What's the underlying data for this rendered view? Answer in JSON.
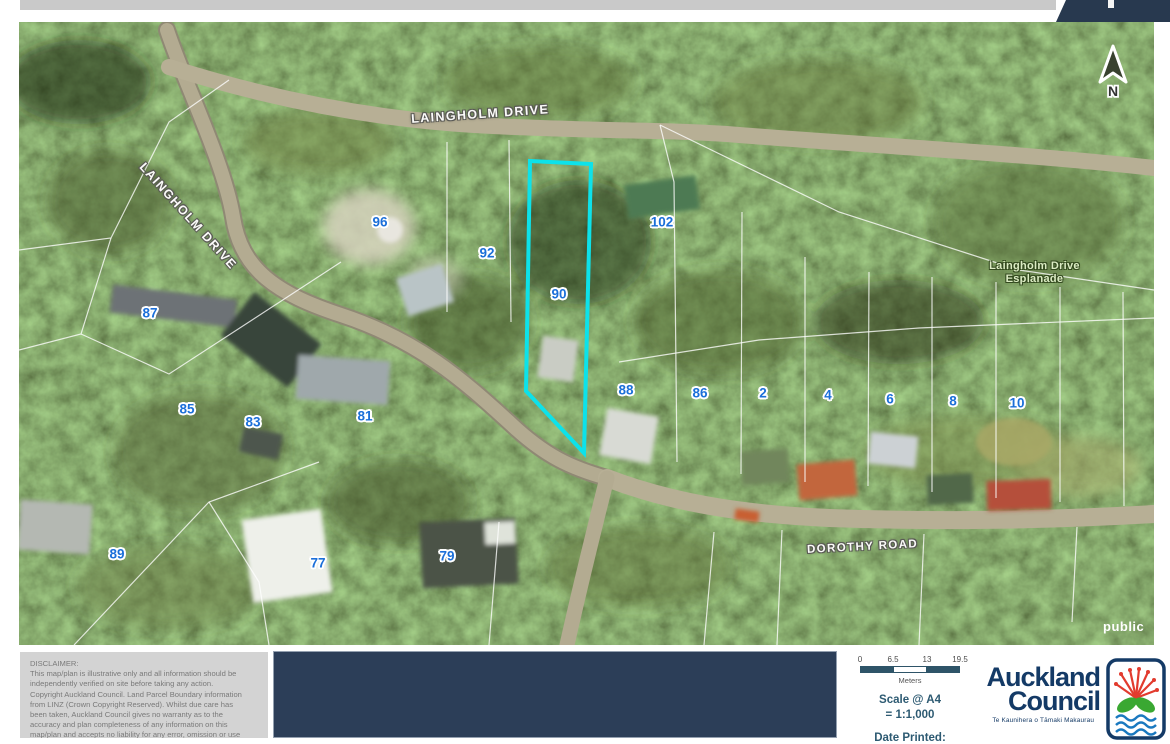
{
  "map": {
    "streets": [
      {
        "label": "LAINGHOLM DRIVE"
      },
      {
        "label": "LAINGHOLM DRIVE"
      },
      {
        "label": "DOROTHY ROAD"
      },
      {
        "label": "Laingholm Drive\nEsplanade"
      }
    ],
    "house_numbers": [
      "96",
      "92",
      "102",
      "90",
      "87",
      "85",
      "83",
      "81",
      "88",
      "86",
      "2",
      "4",
      "6",
      "8",
      "10",
      "89",
      "77",
      "79"
    ],
    "watermark": "public",
    "north_label": "N",
    "highlight_color": "#0de2ea",
    "number_color": "#1b6fd9"
  },
  "footer": {
    "disclaimer": "DISCLAIMER:\nThis map/plan is illustrative only and all information should be\nindependently verified on site before taking any action.\nCopyright Auckland Council.  Land Parcel Boundary information\nfrom LINZ (Crown Copyright Reserved). Whilst due care has\nbeen taken, Auckland Council gives no warranty as to the\naccuracy and plan completeness of any information on this\nmap/plan and accepts no liability for any error, omission or use",
    "scale": {
      "ticks": [
        "0",
        "6.5",
        "13",
        "19.5"
      ],
      "unit": "Meters",
      "line1": "Scale @ A4",
      "line2": "= 1:1,000",
      "date_label": "Date Printed:"
    },
    "logo": {
      "line1": "Auckland",
      "line2": "Council",
      "tagline": "Te Kaunihera o Tāmaki Makaurau"
    }
  }
}
